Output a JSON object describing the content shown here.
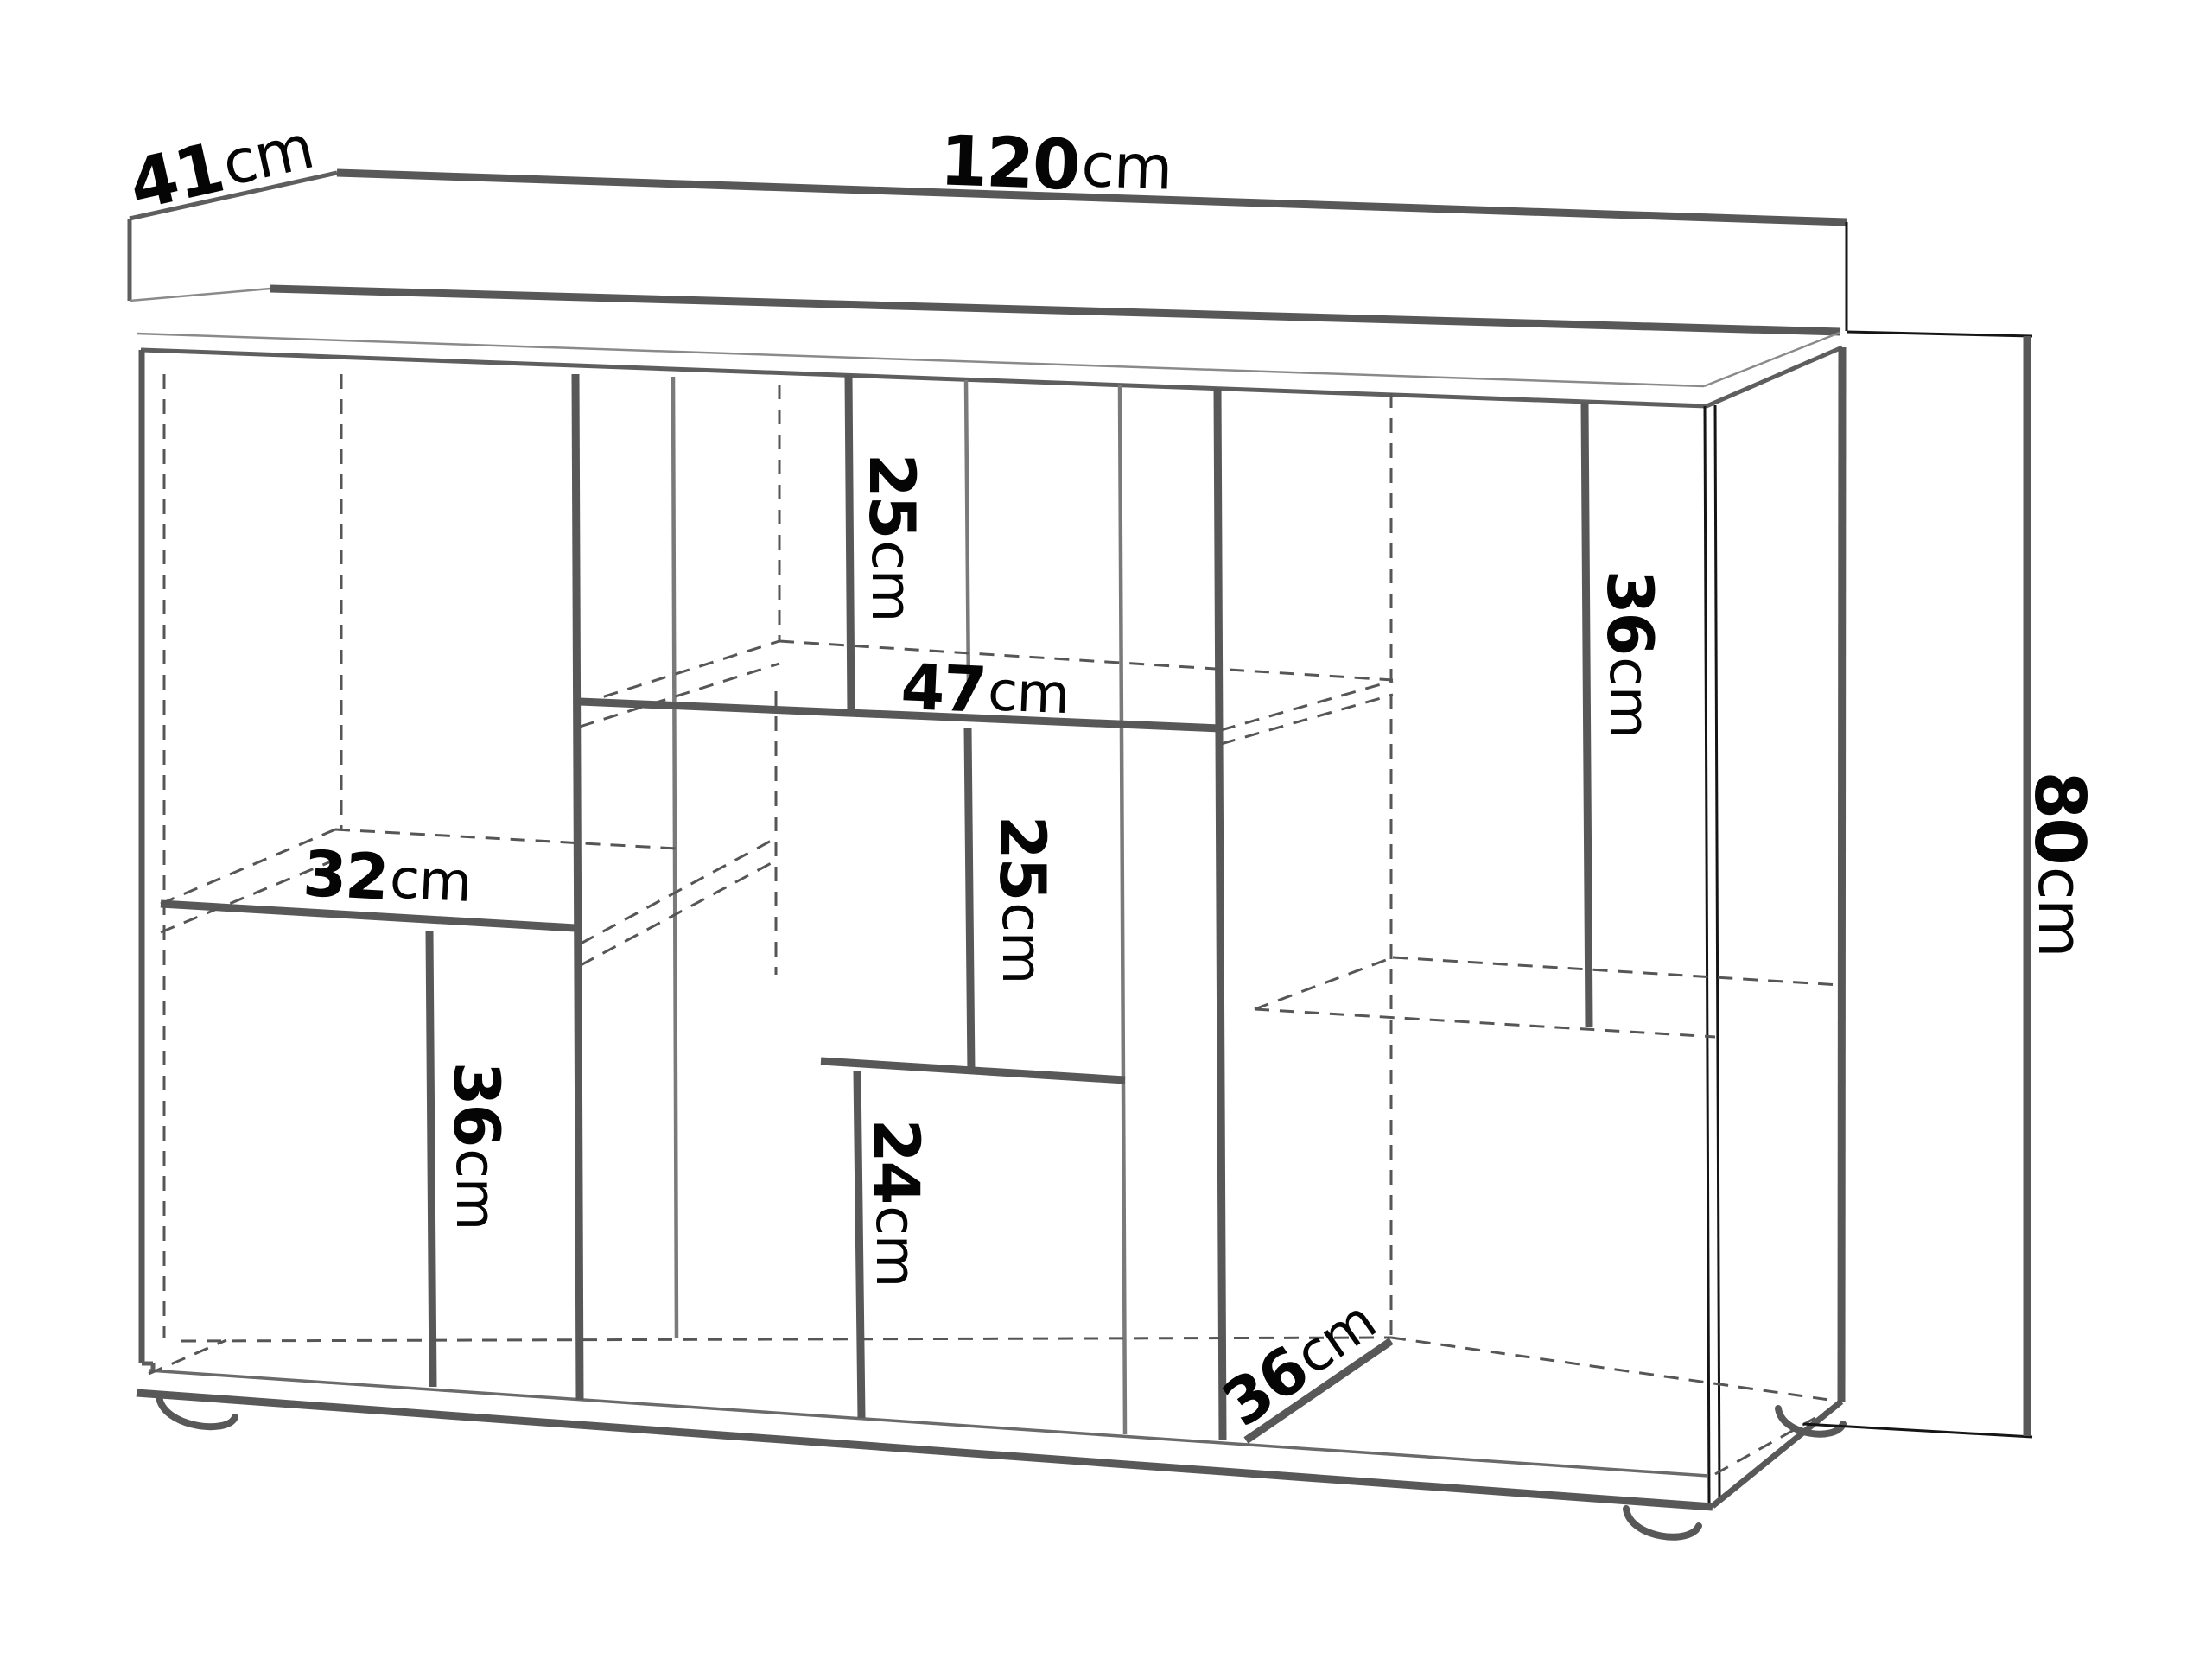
{
  "figure": {
    "type": "furniture-dimension-diagram",
    "item": "sideboard",
    "line_color": "#585858",
    "text_color": "#050505",
    "dimensions": {
      "depth": {
        "value": "41",
        "unit": "cm"
      },
      "width": {
        "value": "120",
        "unit": "cm"
      },
      "height": {
        "value": "80",
        "unit": "cm"
      },
      "top_compartment_height": {
        "value": "25",
        "unit": "cm"
      },
      "middle_shelf_width": {
        "value": "47",
        "unit": "cm"
      },
      "middle_compartment_height": {
        "value": "25",
        "unit": "cm"
      },
      "left_shelf_width": {
        "value": "32",
        "unit": "cm"
      },
      "left_divider_height": {
        "value": "36",
        "unit": "cm"
      },
      "bottom_divider_height": {
        "value": "24",
        "unit": "cm"
      },
      "right_divider_height": {
        "value": "36",
        "unit": "cm"
      },
      "interior_depth": {
        "value": "36",
        "unit": "cm"
      }
    }
  }
}
